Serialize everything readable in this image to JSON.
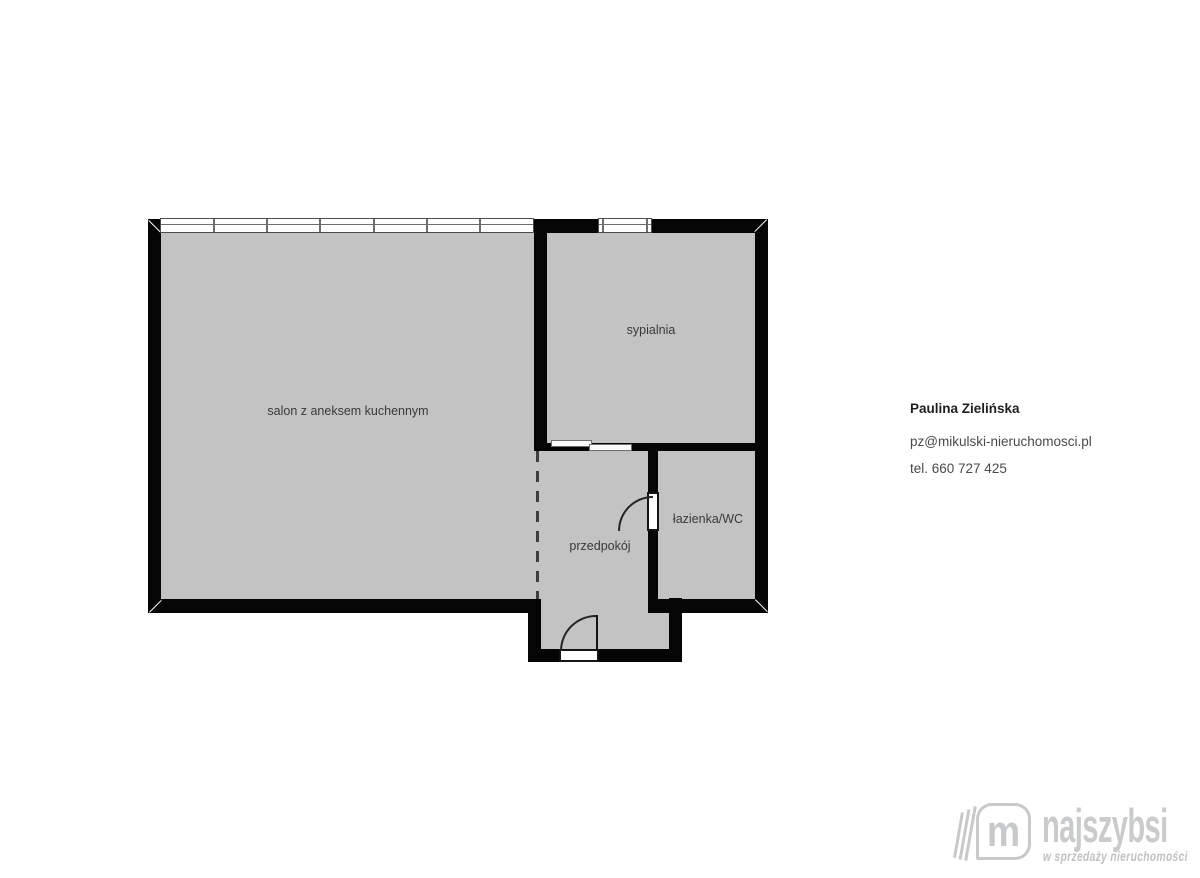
{
  "floorplan": {
    "wall_color": "#050505",
    "floor_color": "#c3c3c3",
    "label_color": "#3a3a3a",
    "rooms": [
      {
        "id": "salon",
        "label": "salon z aneksem kuchennym"
      },
      {
        "id": "sypialnia",
        "label": "sypialnia"
      },
      {
        "id": "lazienka",
        "label": "łazienka/WC"
      },
      {
        "id": "przedpokoj",
        "label": "przedpokój"
      }
    ]
  },
  "contact": {
    "name": "Paulina Zielińska",
    "email": "pz@mikulski-nieruchomosci.pl",
    "phone": "tel. 660 727 425"
  },
  "logo": {
    "mark_letter": "m",
    "brand": "najszybsi",
    "tagline": "w sprzedaży nieruchomości"
  }
}
